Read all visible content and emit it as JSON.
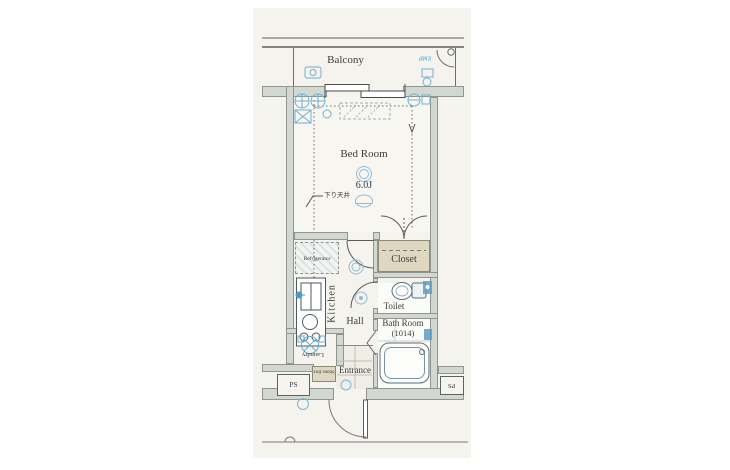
{
  "colors": {
    "background": "#ffffff",
    "paper": "#f5f3ee",
    "wall_fill": "#d2d7d1",
    "wall_edge": "#90968f",
    "line": "#5f5f5f",
    "text": "#3b3b3b",
    "fixture_blue": "#6fb0d2",
    "fixture_blue_dark": "#4a9cc4",
    "closet_tan": "#ded8c2"
  },
  "rooms": {
    "balcony": {
      "label": "Balcony"
    },
    "bedroom": {
      "label": "Bed Room",
      "size": "6.0J",
      "ceiling_note": "下り天井"
    },
    "closet": {
      "label": "Closet"
    },
    "kitchen": {
      "label": "Kitchen"
    },
    "hall": {
      "label": "Hall"
    },
    "toilet": {
      "label": "Toilet"
    },
    "bathroom": {
      "label": "Bath Room",
      "size": "(1014)"
    },
    "laundry": {
      "label": "Laundry"
    },
    "entrance": {
      "label": "Entrance"
    }
  },
  "fixtures": {
    "refrigerator": {
      "label": "Refrigerator"
    },
    "shoes_box": {
      "label": "Shoes Box"
    },
    "ps_left": {
      "label": "PS"
    },
    "ps_right": {
      "label": "PS"
    },
    "emp_panel": {
      "label": "EMP"
    }
  },
  "icons": {
    "ceiling_light": "double-circle",
    "wall_light": "dome-ellipse",
    "exhaust_fan": "circle-with-cross",
    "ac_unit": "dashed-hatched-rect",
    "outlet": "small-circle",
    "toilet_fixture": "bowl-and-tank",
    "bathtub": "rounded-rect",
    "washing_machine": "circle-x-in-square",
    "kitchen_sink": "split-rect",
    "stove": "burner-circles",
    "sliding_window": "double-rail",
    "door_swing": "quarter-arc",
    "folding_closet_doors": "double-petal-arcs"
  }
}
